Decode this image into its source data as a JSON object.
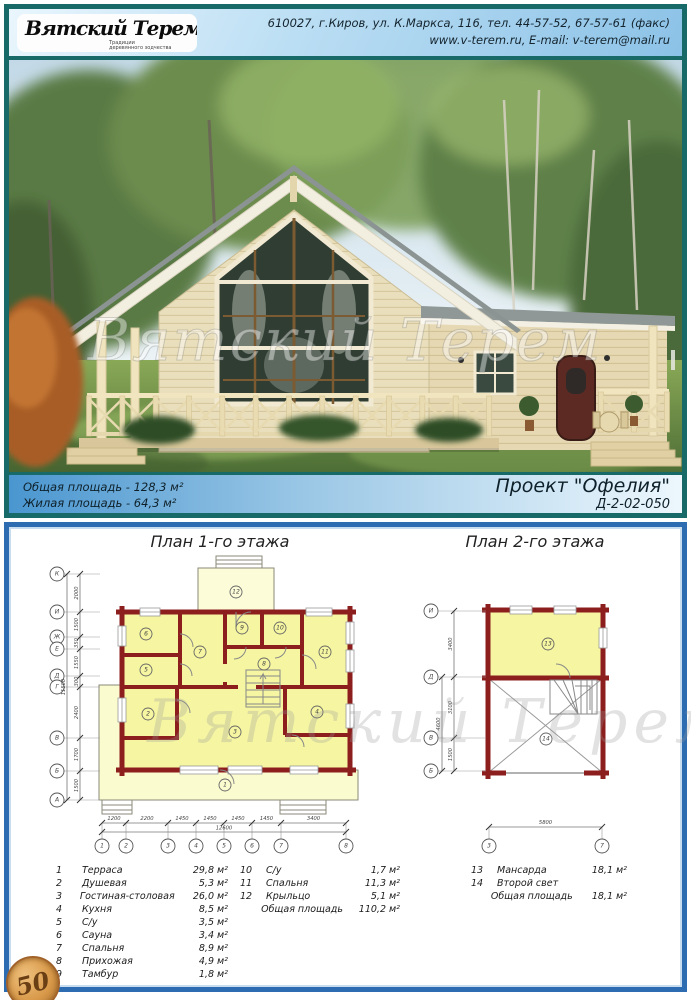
{
  "header": {
    "logo_title": "Вятский Терем",
    "logo_sub1": "Традиции",
    "logo_sub2": "деревянного зодчества",
    "address_line": "610027, г.Киров, ул. К.Маркса, 116, тел. 44-57-52, 67-57-61 (факс)",
    "web_line": "www.v-terem.ru, E-mail: v-terem@mail.ru"
  },
  "info_bar": {
    "total_area": "Общая площадь - 128,3 м²",
    "living_area": "Жилая площадь - 64,3 м²",
    "project_name": "Проект \"Офелия\"",
    "project_code": "Д-2-02-050"
  },
  "watermark": "Вятский Терем",
  "plans": {
    "plan1": {
      "title": "План 1-го этажа",
      "axes_left": [
        "К",
        "И",
        "Ж",
        "Е",
        "Д",
        "Г",
        "В",
        "Б",
        "А"
      ],
      "dims_left": [
        "2000",
        "1500",
        "350",
        "1550",
        "300",
        "2400",
        "1700",
        "1500"
      ],
      "dims_left_total": "11500",
      "axes_bottom": [
        "1",
        "2",
        "3",
        "4",
        "5",
        "6",
        "7",
        "8"
      ],
      "dims_bottom": [
        "1200",
        "2200",
        "1450",
        "1450",
        "1450",
        "1450",
        "3400"
      ],
      "dims_bottom_total": "12600",
      "rooms": [
        "1",
        "2",
        "3",
        "4",
        "5",
        "6",
        "7",
        "8",
        "9",
        "10",
        "11",
        "12"
      ]
    },
    "plan2": {
      "title": "План 2-го этажа",
      "axes_left": [
        "И",
        "Д",
        "В",
        "Б"
      ],
      "dims_left": [
        "3400",
        "3100",
        "1500"
      ],
      "dims_left_total": "4600",
      "axes_bottom": [
        "3",
        "7"
      ],
      "dims_bottom": [
        "5800"
      ],
      "rooms": [
        "13",
        "14"
      ]
    }
  },
  "legend": {
    "columns": [
      {
        "rows": [
          {
            "n": "1",
            "name": "Терраса",
            "area": "29,8 м²"
          },
          {
            "n": "2",
            "name": "Душевая",
            "area": "5,3 м²"
          },
          {
            "n": "3",
            "name": "Гостиная-столовая",
            "area": "26,0 м²"
          },
          {
            "n": "4",
            "name": "Кухня",
            "area": "8,5 м²"
          },
          {
            "n": "5",
            "name": "С/у",
            "area": "3,5 м²"
          },
          {
            "n": "6",
            "name": "Сауна",
            "area": "3,4 м²"
          },
          {
            "n": "7",
            "name": "Спальня",
            "area": "8,9 м²"
          },
          {
            "n": "8",
            "name": "Прихожая",
            "area": "4,9 м²"
          },
          {
            "n": "9",
            "name": "Тамбур",
            "area": "1,8 м²"
          }
        ]
      },
      {
        "rows": [
          {
            "n": "10",
            "name": "С/у",
            "area": "1,7 м²"
          },
          {
            "n": "11",
            "name": "Спальня",
            "area": "11,3 м²"
          },
          {
            "n": "12",
            "name": "Крыльцо",
            "area": "5,1 м²"
          },
          {
            "total": true,
            "n": "",
            "name": "Общая площадь",
            "area": "110,2 м²"
          }
        ]
      },
      {
        "rows": [
          {
            "n": "13",
            "name": "Мансарда",
            "area": "18,1 м²"
          },
          {
            "n": "14",
            "name": "Второй свет",
            "area": ""
          },
          {
            "total": true,
            "n": "",
            "name": "Общая площадь",
            "area": "18,1 м²"
          }
        ]
      }
    ]
  },
  "badge": {
    "number": "50"
  }
}
